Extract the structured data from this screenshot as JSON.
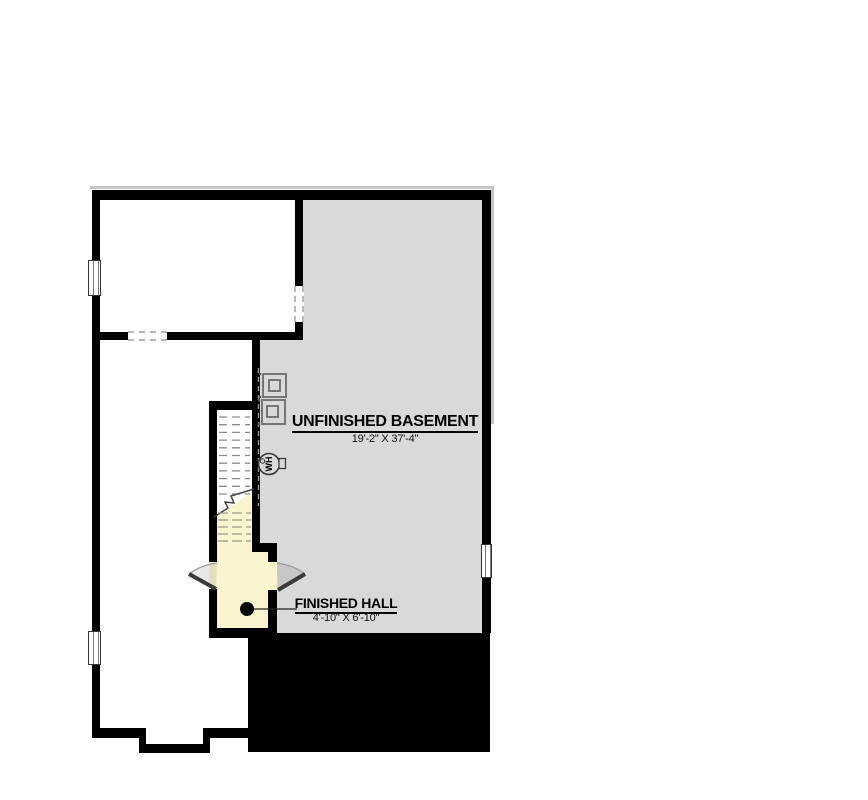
{
  "plan": {
    "type": "basement-floor-plan",
    "labels": {
      "unfinished_basement": {
        "name": "UNFINISHED BASEMENT",
        "dimensions": "19'-2\" X 37'-4\""
      },
      "finished_hall": {
        "name": "FINISHED HALL",
        "dimensions": "4'-10\" X 6'-10\""
      },
      "water_heater": "WH"
    },
    "colors": {
      "wall": "#000000",
      "basement_fill": "#d9d9d9",
      "hall_fill": "#faf4cf",
      "slab_fill": "#000000",
      "tread_line": "#8a8a8a",
      "door_arc": "#999999",
      "outline": "#c4c4c4"
    }
  }
}
